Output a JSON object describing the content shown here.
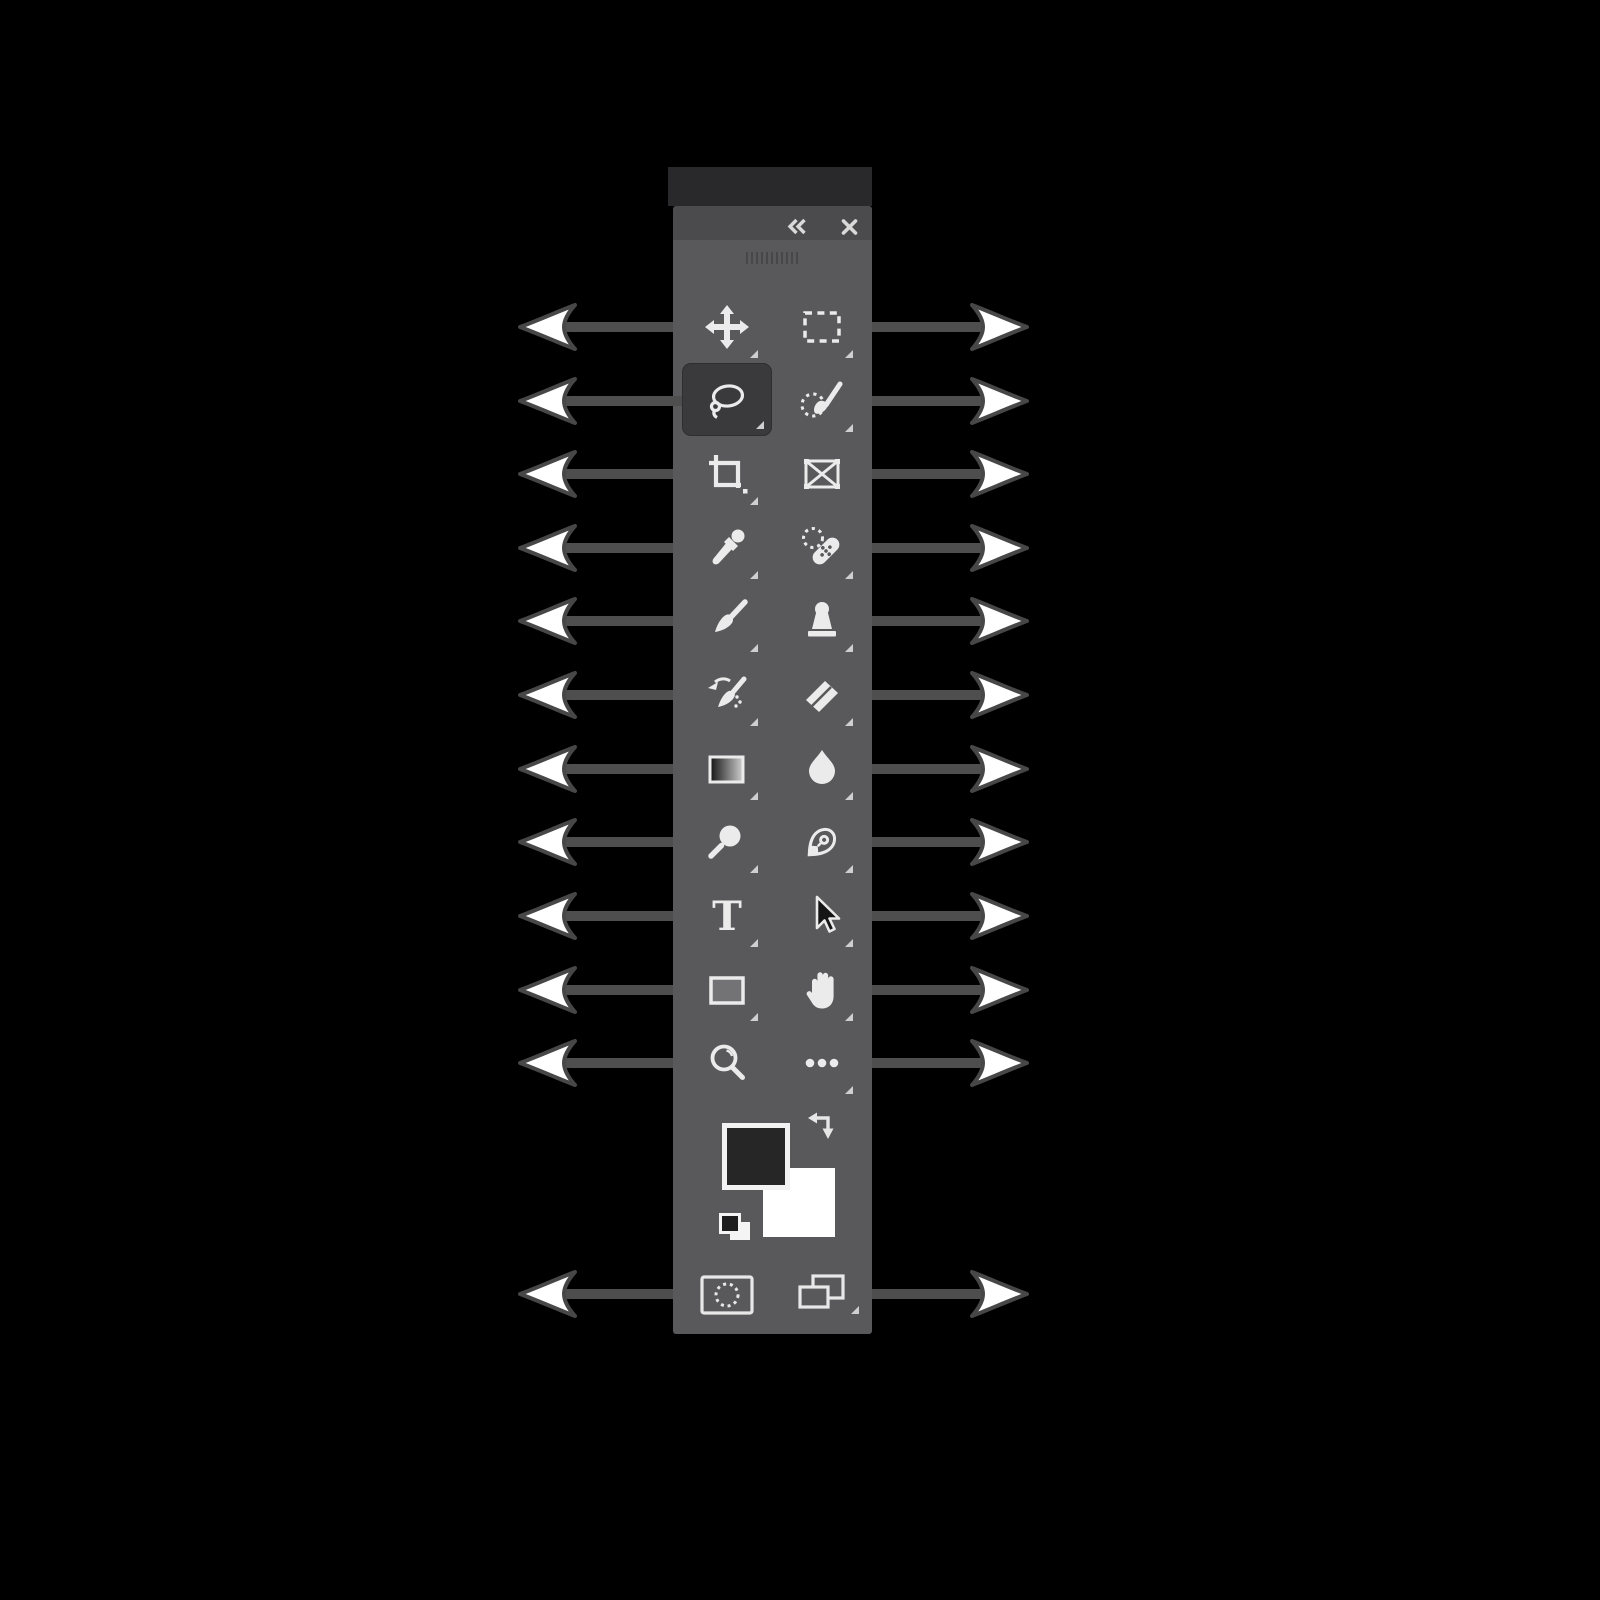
{
  "app": "photoshop-tools-panel-diagram",
  "panel": {
    "header": {
      "collapse_icon": "collapse-double-chevron-icon",
      "close_icon": "close-icon"
    },
    "grip": "panel-drag-grip",
    "type_tool_glyph": "T",
    "selected_tool": "lasso-tool",
    "tools": [
      {
        "id": "move-tool",
        "column": "left",
        "row": 1,
        "has_flyout": true,
        "selected": false
      },
      {
        "id": "rectangular-marquee-tool",
        "column": "right",
        "row": 1,
        "has_flyout": true,
        "selected": false
      },
      {
        "id": "lasso-tool",
        "column": "left",
        "row": 2,
        "has_flyout": true,
        "selected": true
      },
      {
        "id": "object-selection-tool",
        "column": "right",
        "row": 2,
        "has_flyout": true,
        "selected": false
      },
      {
        "id": "crop-tool",
        "column": "left",
        "row": 3,
        "has_flyout": true,
        "selected": false
      },
      {
        "id": "frame-tool",
        "column": "right",
        "row": 3,
        "has_flyout": false,
        "selected": false
      },
      {
        "id": "eyedropper-tool",
        "column": "left",
        "row": 4,
        "has_flyout": true,
        "selected": false
      },
      {
        "id": "spot-healing-brush-tool",
        "column": "right",
        "row": 4,
        "has_flyout": true,
        "selected": false
      },
      {
        "id": "brush-tool",
        "column": "left",
        "row": 5,
        "has_flyout": true,
        "selected": false
      },
      {
        "id": "clone-stamp-tool",
        "column": "right",
        "row": 5,
        "has_flyout": true,
        "selected": false
      },
      {
        "id": "history-brush-tool",
        "column": "left",
        "row": 6,
        "has_flyout": true,
        "selected": false
      },
      {
        "id": "eraser-tool",
        "column": "right",
        "row": 6,
        "has_flyout": true,
        "selected": false
      },
      {
        "id": "gradient-tool",
        "column": "left",
        "row": 7,
        "has_flyout": true,
        "selected": false
      },
      {
        "id": "blur-tool",
        "column": "right",
        "row": 7,
        "has_flyout": true,
        "selected": false
      },
      {
        "id": "dodge-tool",
        "column": "left",
        "row": 8,
        "has_flyout": true,
        "selected": false
      },
      {
        "id": "pen-tool",
        "column": "right",
        "row": 8,
        "has_flyout": true,
        "selected": false
      },
      {
        "id": "type-tool",
        "column": "left",
        "row": 9,
        "has_flyout": true,
        "selected": false
      },
      {
        "id": "path-selection-tool",
        "column": "right",
        "row": 9,
        "has_flyout": true,
        "selected": false
      },
      {
        "id": "rectangle-tool",
        "column": "left",
        "row": 10,
        "has_flyout": true,
        "selected": false
      },
      {
        "id": "hand-tool",
        "column": "right",
        "row": 10,
        "has_flyout": true,
        "selected": false
      },
      {
        "id": "zoom-tool",
        "column": "left",
        "row": 11,
        "has_flyout": false,
        "selected": false
      },
      {
        "id": "edit-toolbar-ellipsis",
        "column": "right",
        "row": 11,
        "has_flyout": true,
        "selected": false
      }
    ],
    "color_controls": {
      "foreground_color": "#262626",
      "background_color": "#ffffff",
      "swap_colors_icon": "swap-colors-icon",
      "default_colors_icon": "default-colors-icon"
    },
    "bottom_controls": [
      {
        "id": "quick-mask-mode-button",
        "has_flyout": false
      },
      {
        "id": "screen-mode-button",
        "has_flyout": true
      }
    ],
    "colors": {
      "dock_header": "#29292b",
      "title_bar": "#4b4b4d",
      "body": "#59595b",
      "selected_tool_bg": "#3a3a3d",
      "icon": "#ebebeb",
      "flyout_triangle": "#cfcfcf"
    }
  },
  "annotations": {
    "left_arrow_count": 12,
    "right_arrow_count": 12,
    "arrow_style": {
      "shaft_color": "#4e4e4e",
      "head_fill": "#ffffff",
      "head_outline": "#474747"
    }
  },
  "canvas_background": "#000000"
}
